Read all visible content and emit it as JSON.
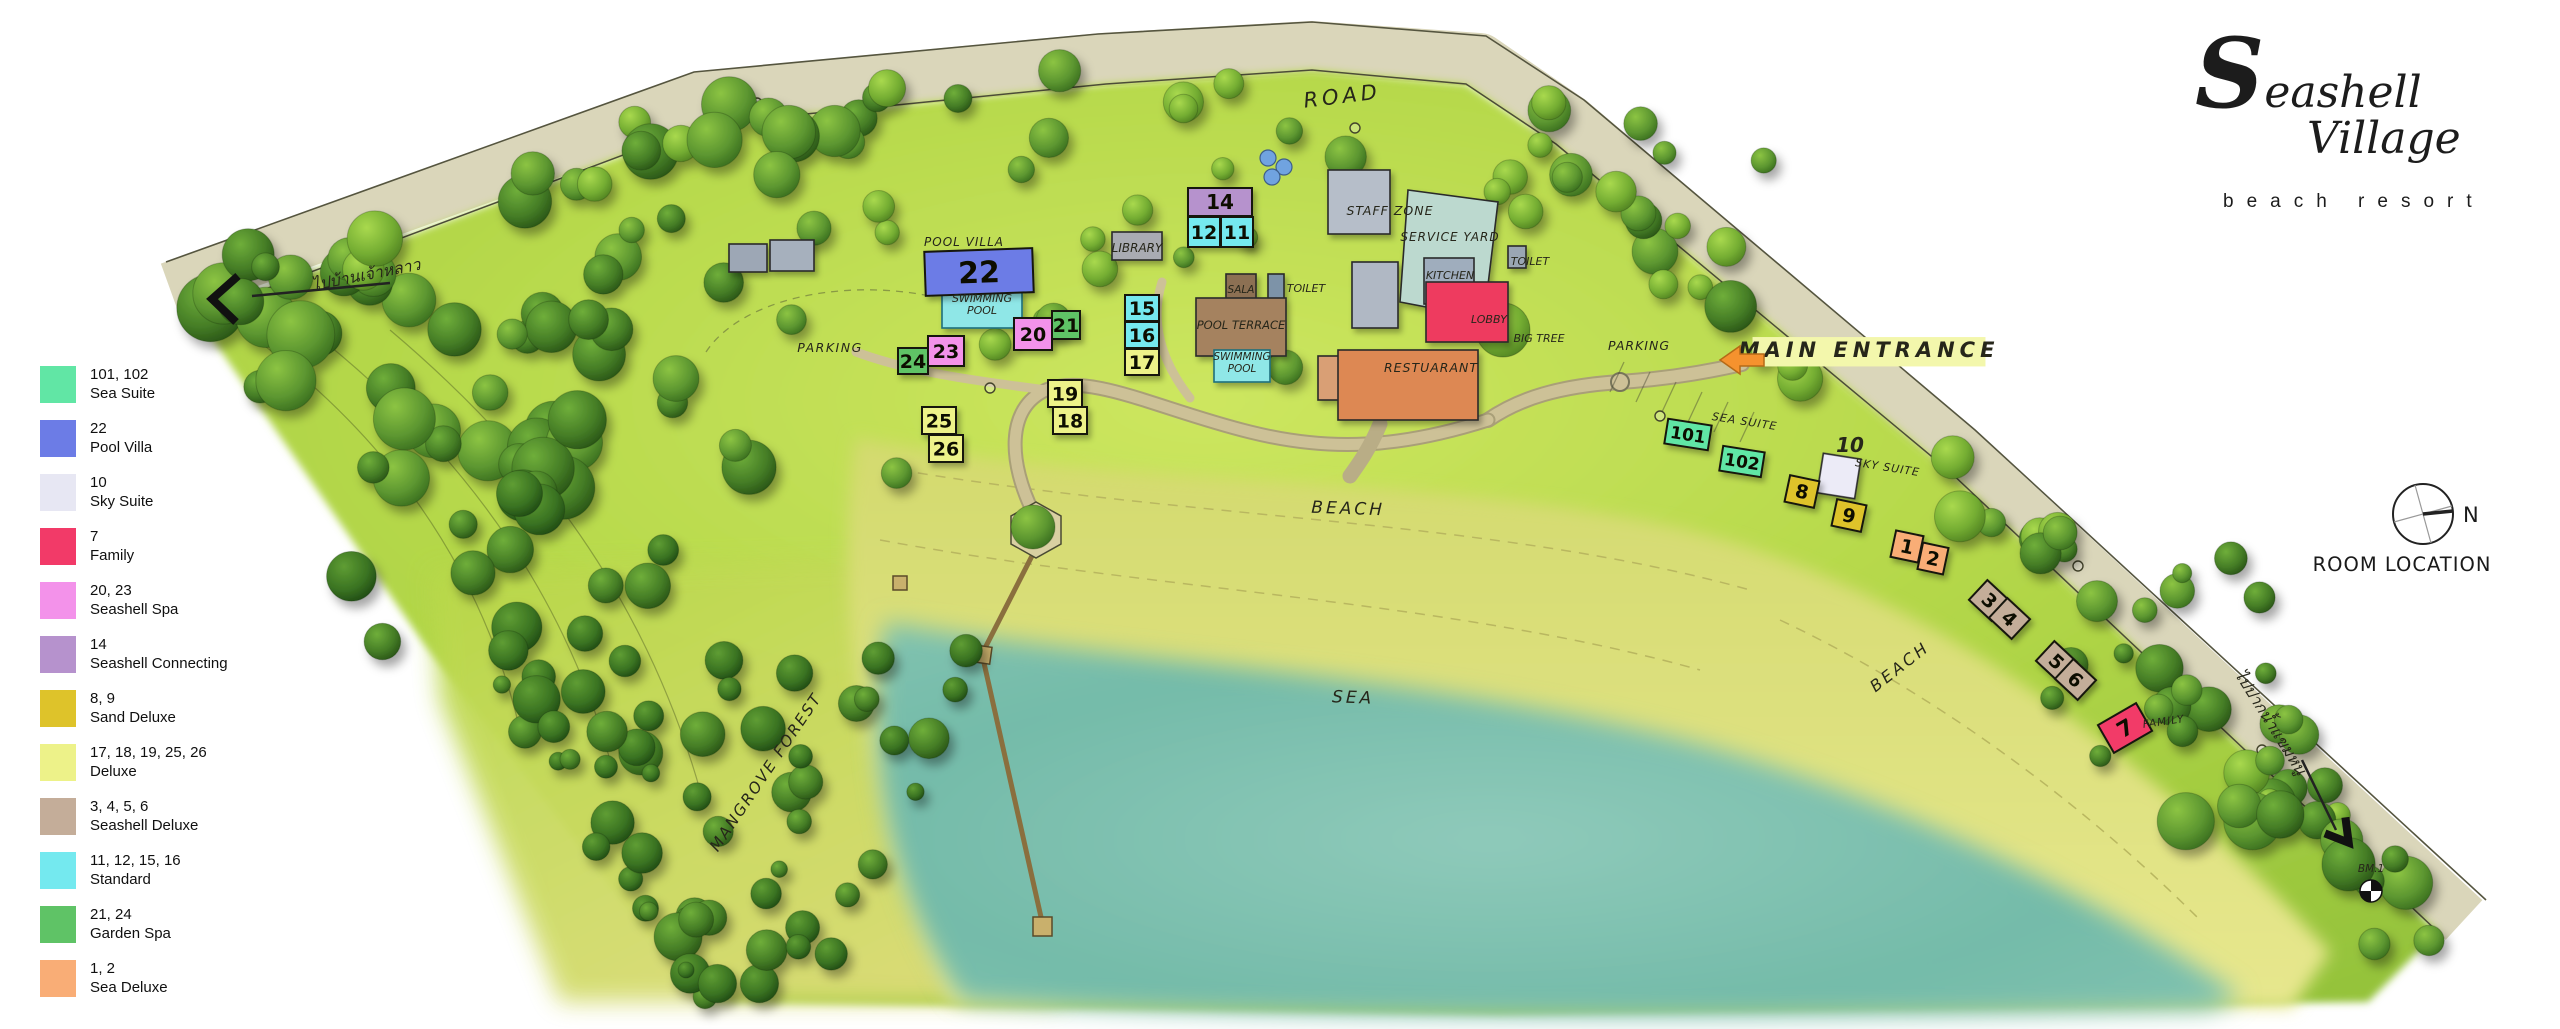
{
  "branding": {
    "wordmark_top": "Seashell",
    "wordmark_bottom": "Village",
    "tagline": "beach resort"
  },
  "compass": {
    "north_label": "N",
    "caption": "ROOM LOCATION"
  },
  "legend": {
    "items": [
      {
        "rooms": "101, 102",
        "name": "Sea Suite",
        "color": "#61e6a5"
      },
      {
        "rooms": "22",
        "name": "Pool Villa",
        "color": "#6c7ce6"
      },
      {
        "rooms": "10",
        "name": "Sky Suite",
        "color": "#e7e7f3"
      },
      {
        "rooms": "7",
        "name": "Family",
        "color": "#f23a68"
      },
      {
        "rooms": "20, 23",
        "name": "Seashell Spa",
        "color": "#f392ea"
      },
      {
        "rooms": "14",
        "name": "Seashell Connecting",
        "color": "#b692cd"
      },
      {
        "rooms": "8, 9",
        "name": "Sand Deluxe",
        "color": "#dec32a"
      },
      {
        "rooms": "17, 18, 19, 25, 26",
        "name": "Deluxe",
        "color": "#edf289"
      },
      {
        "rooms": "3, 4, 5, 6",
        "name": "Seashell Deluxe",
        "color": "#c4ad99"
      },
      {
        "rooms": "11, 12, 15, 16",
        "name": "Standard",
        "color": "#74e9ef"
      },
      {
        "rooms": "21, 24",
        "name": "Garden Spa",
        "color": "#5fc366"
      },
      {
        "rooms": "1, 2",
        "name": "Sea Deluxe",
        "color": "#f9ad76"
      }
    ]
  },
  "map": {
    "colors": {
      "road_band": "#dad6ba",
      "site_green": "#b3d74a",
      "sand": "#e0e07e",
      "sea": "#74bba9",
      "path": "#cdc197",
      "pier": "#8a6f3e"
    },
    "room_types": {
      "sea_suite": "#61e6a5",
      "pool_villa": "#6c7ce6",
      "sky_suite": "#ecebf7",
      "family": "#f23a68",
      "seashell_spa": "#f392ea",
      "seashell_connecting": "#b692cd",
      "sand_deluxe": "#dec32a",
      "deluxe": "#edf289",
      "seashell_deluxe": "#c4ad99",
      "standard": "#74e9ef",
      "garden_spa": "#5fc366",
      "sea_deluxe": "#f9ad76"
    },
    "rooms": [
      {
        "label": "22",
        "type": "pool_villa",
        "x": 925,
        "y": 250,
        "w": 108,
        "h": 44,
        "rot": -2,
        "fs": 30
      },
      {
        "label": "24",
        "type": "garden_spa",
        "x": 898,
        "y": 348,
        "w": 30,
        "h": 26
      },
      {
        "label": "23",
        "type": "seashell_spa",
        "x": 928,
        "y": 336,
        "w": 36,
        "h": 30
      },
      {
        "label": "20",
        "type": "seashell_spa",
        "x": 1014,
        "y": 318,
        "w": 38,
        "h": 32
      },
      {
        "label": "21",
        "type": "garden_spa",
        "x": 1052,
        "y": 311,
        "w": 28,
        "h": 28
      },
      {
        "label": "19",
        "type": "deluxe",
        "x": 1048,
        "y": 380,
        "w": 34,
        "h": 27
      },
      {
        "label": "18",
        "type": "deluxe",
        "x": 1053,
        "y": 407,
        "w": 34,
        "h": 27
      },
      {
        "label": "25",
        "type": "deluxe",
        "x": 922,
        "y": 407,
        "w": 34,
        "h": 27
      },
      {
        "label": "26",
        "type": "deluxe",
        "x": 929,
        "y": 435,
        "w": 34,
        "h": 27
      },
      {
        "label": "14",
        "type": "seashell_connecting",
        "x": 1188,
        "y": 188,
        "w": 64,
        "h": 28,
        "fs": 20
      },
      {
        "label": "12",
        "type": "standard",
        "x": 1188,
        "y": 217,
        "w": 32,
        "h": 30
      },
      {
        "label": "11",
        "type": "standard",
        "x": 1221,
        "y": 217,
        "w": 32,
        "h": 30
      },
      {
        "label": "15",
        "type": "standard",
        "x": 1125,
        "y": 295,
        "w": 34,
        "h": 26
      },
      {
        "label": "16",
        "type": "standard",
        "x": 1125,
        "y": 322,
        "w": 34,
        "h": 26
      },
      {
        "label": "17",
        "type": "deluxe",
        "x": 1125,
        "y": 349,
        "w": 34,
        "h": 26
      },
      {
        "label": "101",
        "type": "sea_suite",
        "x": 1666,
        "y": 422,
        "w": 44,
        "h": 25,
        "rot": 9,
        "fs": 17
      },
      {
        "label": "102",
        "type": "sea_suite",
        "x": 1721,
        "y": 449,
        "w": 42,
        "h": 25,
        "rot": 9,
        "fs": 17
      },
      {
        "label": "8",
        "type": "sand_deluxe",
        "x": 1787,
        "y": 478,
        "w": 30,
        "h": 27,
        "rot": 12
      },
      {
        "label": "9",
        "type": "sand_deluxe",
        "x": 1834,
        "y": 502,
        "w": 30,
        "h": 27,
        "rot": 12
      },
      {
        "label": "1",
        "type": "sea_deluxe",
        "x": 1893,
        "y": 533,
        "w": 28,
        "h": 27,
        "rot": 12
      },
      {
        "label": "2",
        "type": "sea_deluxe",
        "x": 1920,
        "y": 545,
        "w": 26,
        "h": 27,
        "rot": 12
      },
      {
        "label": "3",
        "type": "seashell_deluxe",
        "x": 1974,
        "y": 587,
        "w": 31,
        "h": 27,
        "rot": 43
      },
      {
        "label": "4",
        "type": "seashell_deluxe",
        "x": 1994,
        "y": 605,
        "w": 31,
        "h": 27,
        "rot": 43
      },
      {
        "label": "5",
        "type": "seashell_deluxe",
        "x": 2041,
        "y": 648,
        "w": 31,
        "h": 27,
        "rot": 43
      },
      {
        "label": "6",
        "type": "seashell_deluxe",
        "x": 2060,
        "y": 666,
        "w": 31,
        "h": 27,
        "rot": 43
      },
      {
        "label": "7",
        "type": "family",
        "x": 2103,
        "y": 712,
        "w": 44,
        "h": 32,
        "rot": -30,
        "fs": 22
      }
    ],
    "facilities": [
      {
        "name": "storage-a",
        "x": 729,
        "y": 244,
        "w": 38,
        "h": 28,
        "color": "#9da7b5"
      },
      {
        "name": "storage-b",
        "x": 770,
        "y": 240,
        "w": 44,
        "h": 31,
        "color": "#a6b0bd"
      },
      {
        "name": "library",
        "x": 1112,
        "y": 232,
        "w": 50,
        "h": 28,
        "color": "#a9abb2"
      },
      {
        "name": "villa-swimming-pool",
        "x": 942,
        "y": 292,
        "w": 80,
        "h": 36,
        "color": "#8fe7e7",
        "stroke": "#1f6f7d"
      },
      {
        "name": "staff-zone-building",
        "x": 1328,
        "y": 170,
        "w": 62,
        "h": 64,
        "color": "#b6bec9"
      },
      {
        "name": "back-of-house",
        "x": 1352,
        "y": 262,
        "w": 46,
        "h": 66,
        "color": "#b0b8c4"
      },
      {
        "name": "service-yard",
        "poly": "1408,190 1498,202 1484,318 1400,302",
        "color": "#bcd9cf"
      },
      {
        "name": "kitchen",
        "x": 1424,
        "y": 258,
        "w": 50,
        "h": 46,
        "color": "#9fadbd"
      },
      {
        "name": "toilet-west",
        "x": 1268,
        "y": 274,
        "w": 16,
        "h": 28,
        "color": "#7d93a8"
      },
      {
        "name": "toilet-east",
        "x": 1508,
        "y": 246,
        "w": 18,
        "h": 22,
        "color": "#9aa6b3"
      },
      {
        "name": "sala",
        "x": 1226,
        "y": 274,
        "w": 30,
        "h": 30,
        "color": "#8c6f52"
      },
      {
        "name": "pool-terrace",
        "x": 1196,
        "y": 298,
        "w": 90,
        "h": 58,
        "color": "#a5825f"
      },
      {
        "name": "terrace-swimming-pool",
        "x": 1214,
        "y": 350,
        "w": 56,
        "h": 32,
        "color": "#8fe7e7",
        "stroke": "#1f6f7d"
      },
      {
        "name": "lobby",
        "x": 1426,
        "y": 282,
        "w": 82,
        "h": 60,
        "color": "#ee3a5e"
      },
      {
        "name": "restaurant-annex",
        "x": 1318,
        "y": 356,
        "w": 22,
        "h": 44,
        "color": "#d99f74"
      },
      {
        "name": "restaurant",
        "x": 1338,
        "y": 350,
        "w": 140,
        "h": 70,
        "color": "#dd8852"
      },
      {
        "name": "sky-suite-building",
        "x": 1820,
        "y": 456,
        "w": 38,
        "h": 40,
        "color": "#ecebf7",
        "rot": 9
      }
    ],
    "annotations": [
      {
        "name": "road",
        "text": "ROAD",
        "x": 1343,
        "y": 103,
        "rot": -7,
        "fs": 21,
        "ls": 4
      },
      {
        "name": "thai-west",
        "text": "ไปบ้านเจ้าหลาว",
        "x": 367,
        "y": 280,
        "rot": -11,
        "fs": 16
      },
      {
        "name": "parking-west",
        "text": "PARKING",
        "x": 830,
        "y": 352,
        "fs": 12.5,
        "ls": 1.5
      },
      {
        "name": "pool-villa",
        "text": "POOL VILLA",
        "x": 964,
        "y": 246,
        "fs": 12,
        "ls": 1
      },
      {
        "name": "swimming-pool-villa",
        "text": "SWIMMING POOL",
        "lines": [
          "SWIMMING",
          "POOL"
        ],
        "x": 982,
        "y": 308,
        "fs": 11
      },
      {
        "name": "library",
        "text": "LIBRARY",
        "x": 1137,
        "y": 252,
        "fs": 12
      },
      {
        "name": "sala",
        "text": "SALA",
        "x": 1241,
        "y": 293,
        "fs": 10.5
      },
      {
        "name": "toilet-west",
        "text": "TOILET",
        "x": 1306,
        "y": 292,
        "fs": 11
      },
      {
        "name": "pool-terrace",
        "text": "POOL TERRACE",
        "x": 1241,
        "y": 329,
        "fs": 11.5
      },
      {
        "name": "swimming-pool-terrace",
        "text": "SWIMMING POOL",
        "lines": [
          "SWIMMING",
          "POOL"
        ],
        "x": 1242,
        "y": 366,
        "fs": 10.5
      },
      {
        "name": "staff-zone",
        "text": "STAFF ZONE",
        "x": 1390,
        "y": 215,
        "fs": 12.5,
        "ls": 1
      },
      {
        "name": "service-yard",
        "text": "SERVICE YARD",
        "x": 1450,
        "y": 241,
        "fs": 12,
        "ls": 1
      },
      {
        "name": "kitchen",
        "text": "KITCHEN",
        "x": 1450,
        "y": 279,
        "fs": 11
      },
      {
        "name": "toilet-east",
        "text": "TOILET",
        "x": 1530,
        "y": 265,
        "fs": 11
      },
      {
        "name": "lobby",
        "text": "LOBBY",
        "x": 1489,
        "y": 323,
        "fs": 11
      },
      {
        "name": "big-tree",
        "text": "BIG TREE",
        "x": 1539,
        "y": 342,
        "fs": 11
      },
      {
        "name": "restaurant",
        "text": "RESTUARANT",
        "x": 1431,
        "y": 372,
        "fs": 12.5,
        "ls": 1
      },
      {
        "name": "parking-east",
        "text": "PARKING",
        "x": 1639,
        "y": 350,
        "fs": 12.5,
        "ls": 1
      },
      {
        "name": "main-entrance",
        "text": "MAIN ENTRANCE",
        "x": 1869,
        "y": 357,
        "fs": 21,
        "ls": 5,
        "bold": true,
        "bg": "#f3f7ac"
      },
      {
        "name": "sea-suite",
        "text": "SEA SUITE",
        "x": 1744,
        "y": 425,
        "rot": 9,
        "fs": 11,
        "ls": 1
      },
      {
        "name": "room-10-number",
        "text": "10",
        "x": 1850,
        "y": 452,
        "fs": 20,
        "bold": true
      },
      {
        "name": "sky-suite",
        "text": "SKY SUITE",
        "x": 1887,
        "y": 471,
        "rot": 9,
        "fs": 11,
        "ls": 1
      },
      {
        "name": "beach-central",
        "text": "BEACH",
        "x": 1348,
        "y": 514,
        "rot": 2,
        "fs": 17,
        "ls": 3
      },
      {
        "name": "sea",
        "text": "SEA",
        "x": 1353,
        "y": 703,
        "rot": 2,
        "fs": 17,
        "ls": 3
      },
      {
        "name": "beach-east",
        "text": "BEACH",
        "x": 1903,
        "y": 671,
        "rot": -38,
        "fs": 16,
        "ls": 3
      },
      {
        "name": "family",
        "text": "FAMILY",
        "x": 2164,
        "y": 725,
        "rot": -8,
        "fs": 10.5,
        "ls": 1
      },
      {
        "name": "mangrove-forest",
        "text": "MANGROVE FOREST",
        "x": 770,
        "y": 775,
        "rot": -56,
        "fs": 15.5,
        "ls": 2
      },
      {
        "name": "thai-east",
        "text": "ไปปากน้ำแขมหนู",
        "x": 2266,
        "y": 725,
        "rot": 58,
        "fs": 16
      },
      {
        "name": "benchmark",
        "text": "BM.1",
        "x": 2371,
        "y": 872,
        "fs": 10.5
      }
    ]
  }
}
